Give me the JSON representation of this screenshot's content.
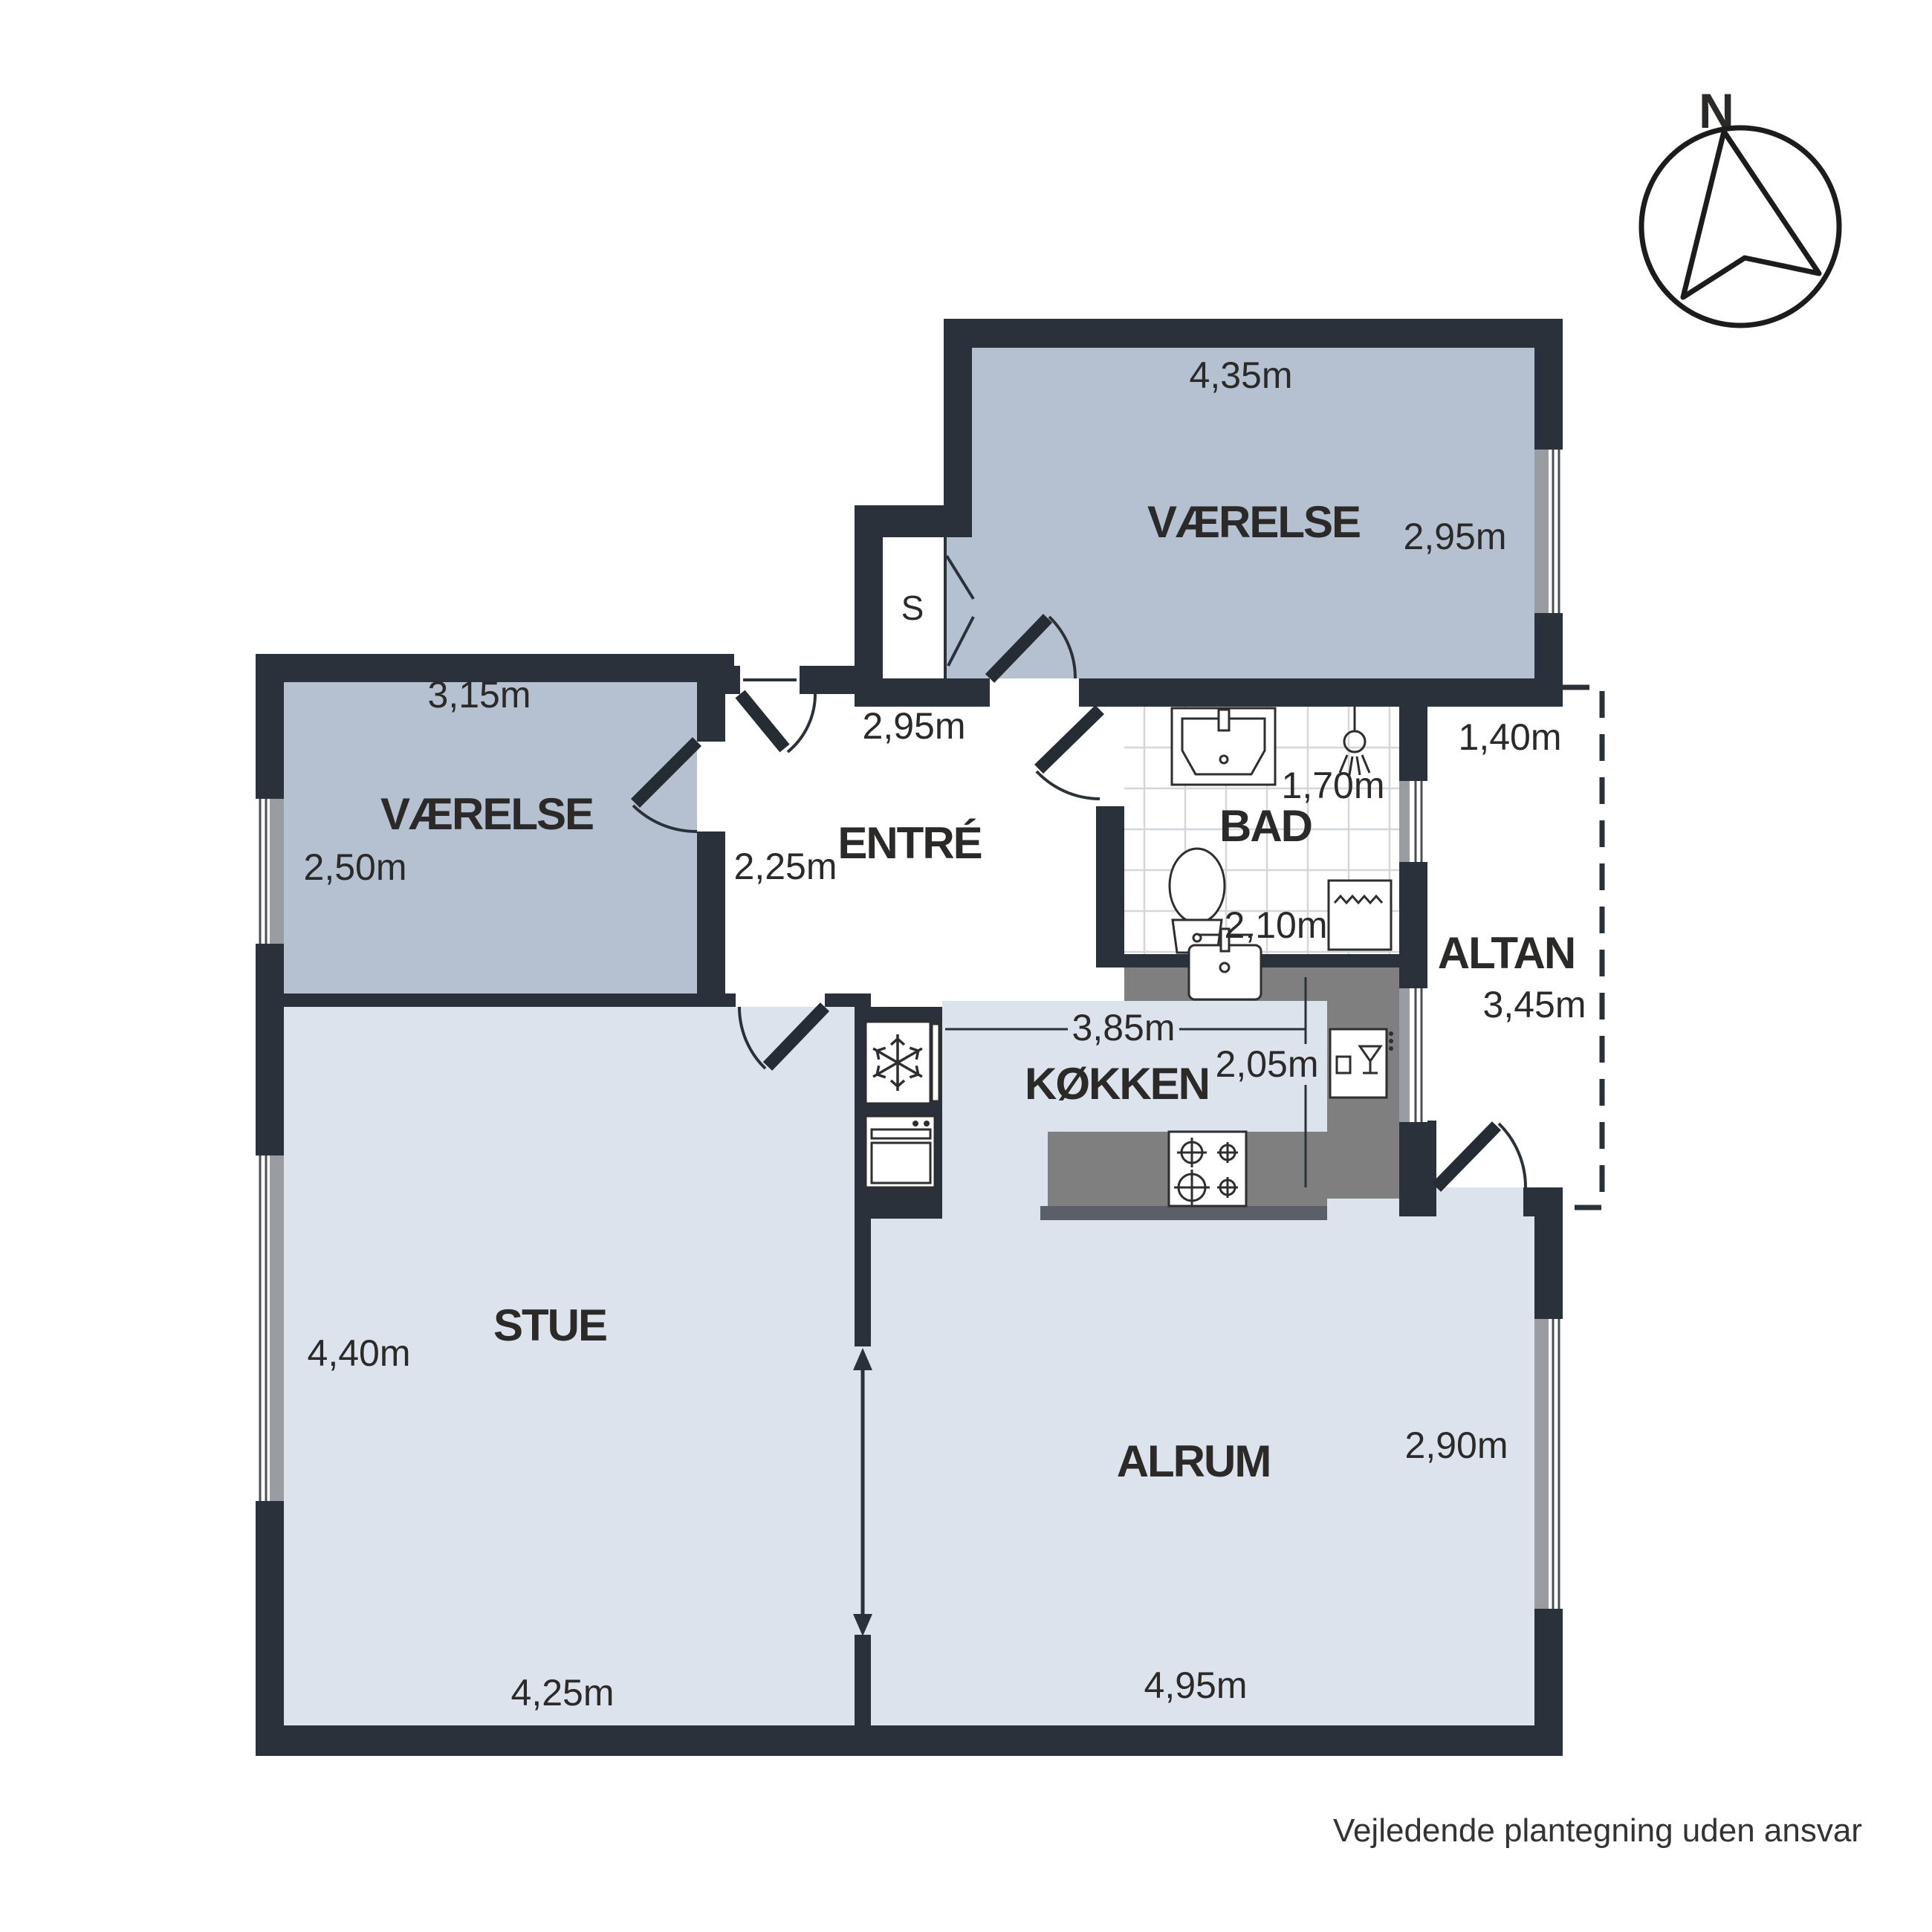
{
  "compass": {
    "label": "N"
  },
  "footer": {
    "disclaimer": "Vejledende plantegning uden ansvar"
  },
  "rooms": {
    "vaerelse_north": {
      "name": "VÆRELSE",
      "dim_width": "4,35m",
      "dim_depth": "2,95m"
    },
    "vaerelse_west": {
      "name": "VÆRELSE",
      "dim_width": "3,15m",
      "dim_depth": "2,50m"
    },
    "entre": {
      "name": "ENTRÉ",
      "dim_width": "2,95m",
      "dim_depth": "2,25m"
    },
    "bad": {
      "name": "BAD",
      "dim_width": "1,70m",
      "dim_depth": "2,10m"
    },
    "altan": {
      "name": "ALTAN",
      "dim_width": "1,40m",
      "dim_depth": "3,45m"
    },
    "koekken": {
      "name": "KØKKEN",
      "dim_width": "3,85m",
      "dim_depth": "2,05m"
    },
    "stue": {
      "name": "STUE",
      "dim_width": "4,25m",
      "dim_depth": "4,40m"
    },
    "alrum": {
      "name": "ALRUM",
      "dim_width": "4,95m",
      "dim_depth": "2,90m"
    },
    "closet": {
      "label": "S"
    }
  },
  "colors": {
    "wall": "#2a313b",
    "bedroom_floor": "#b5c0d1",
    "living_floor": "#dce3ed",
    "counter": "#7f7f7f",
    "counter_shadow": "#5b6068",
    "window_sill": "#999da1",
    "tile_line": "#d3d7da",
    "text": "#2b2a28"
  }
}
